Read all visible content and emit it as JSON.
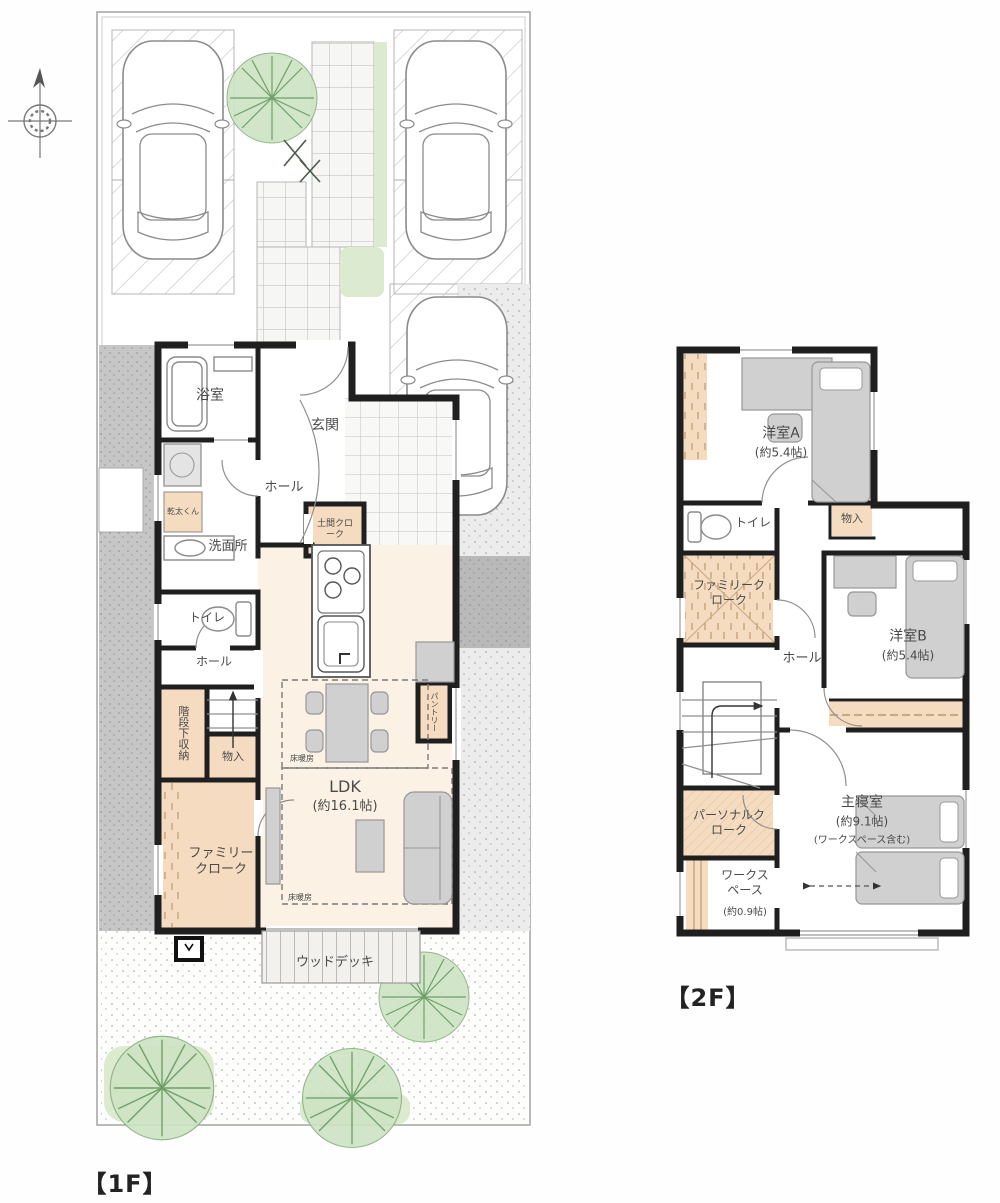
{
  "meta": {
    "drawing_type": "floor-plan"
  },
  "floor1": {
    "title": "【1F】",
    "rooms": {
      "bath": "浴室",
      "entrance": "玄関",
      "hall_upper": "ホール",
      "washroom": "洗面所",
      "dryer": "乾太くん",
      "doma_cloak": "土間クローク",
      "toilet": "トイレ",
      "hall_lower": "ホール",
      "under_stair_storage": "階段下収納",
      "closet": "物入",
      "family_cloak": "ファミリークローク",
      "ldk": "LDK",
      "ldk_size": "(約16.1帖)",
      "floor_heating": "床暖房",
      "pantry": "パントリー",
      "wood_deck": "ウッドデッキ"
    }
  },
  "floor2": {
    "title": "【2F】",
    "rooms": {
      "room_a": "洋室A",
      "room_a_size": "(約5.4帖)",
      "toilet": "トイレ",
      "closet": "物入",
      "family_cloak": "ファミリークローク",
      "hall": "ホール",
      "room_b": "洋室B",
      "room_b_size": "(約5.4帖)",
      "personal_cloak": "パーソナルクローク",
      "master": "主寝室",
      "master_size": "(約9.1帖)",
      "master_note": "(ワークスペース含む)",
      "workspace": "ワークスペース",
      "workspace_size": "(約0.9帖)"
    }
  },
  "colors": {
    "wall": "#1f1f1f",
    "closet": "#f5dcc0",
    "furn": "#d0d0d0",
    "ldk": "#fbf1e5",
    "tree": "#a9cf9f",
    "lawn": "#dcead0",
    "grayband": "#c6c6c6"
  }
}
